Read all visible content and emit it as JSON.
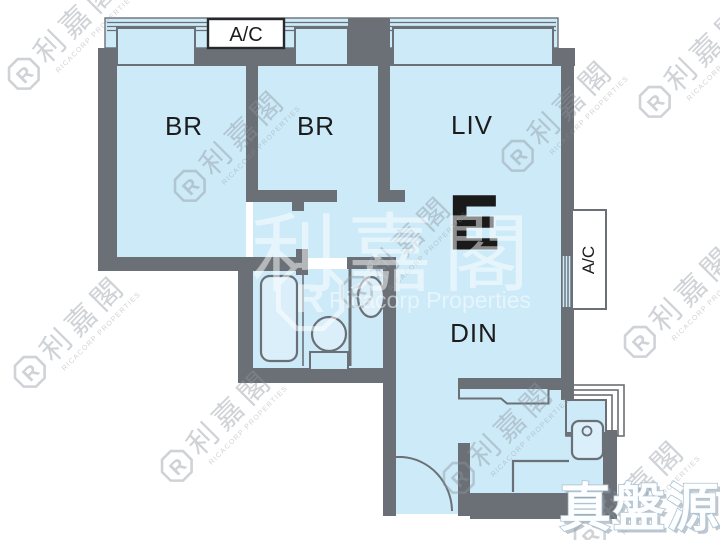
{
  "floorplan": {
    "unit_label": "E",
    "rooms": {
      "bedroom1": "BR",
      "bedroom2": "BR",
      "living": "LIV",
      "dining": "DIN"
    },
    "ac_top": "A/C",
    "ac_right": "A/C",
    "colors": {
      "floor": "#cdeaf8",
      "wall": "#6b7076",
      "fixture_fill": "#dbeffb",
      "ac_box": "#ffffff",
      "label_text": "#1c1c1c"
    }
  },
  "watermarks": {
    "logo_letter": "R",
    "ricacorp_cjk": "利嘉閣",
    "ricacorp_caps": "RICACORP PROPERTIES",
    "ricacorp_latin": "Ricacorp Properties",
    "source_badge": "真盤源"
  }
}
